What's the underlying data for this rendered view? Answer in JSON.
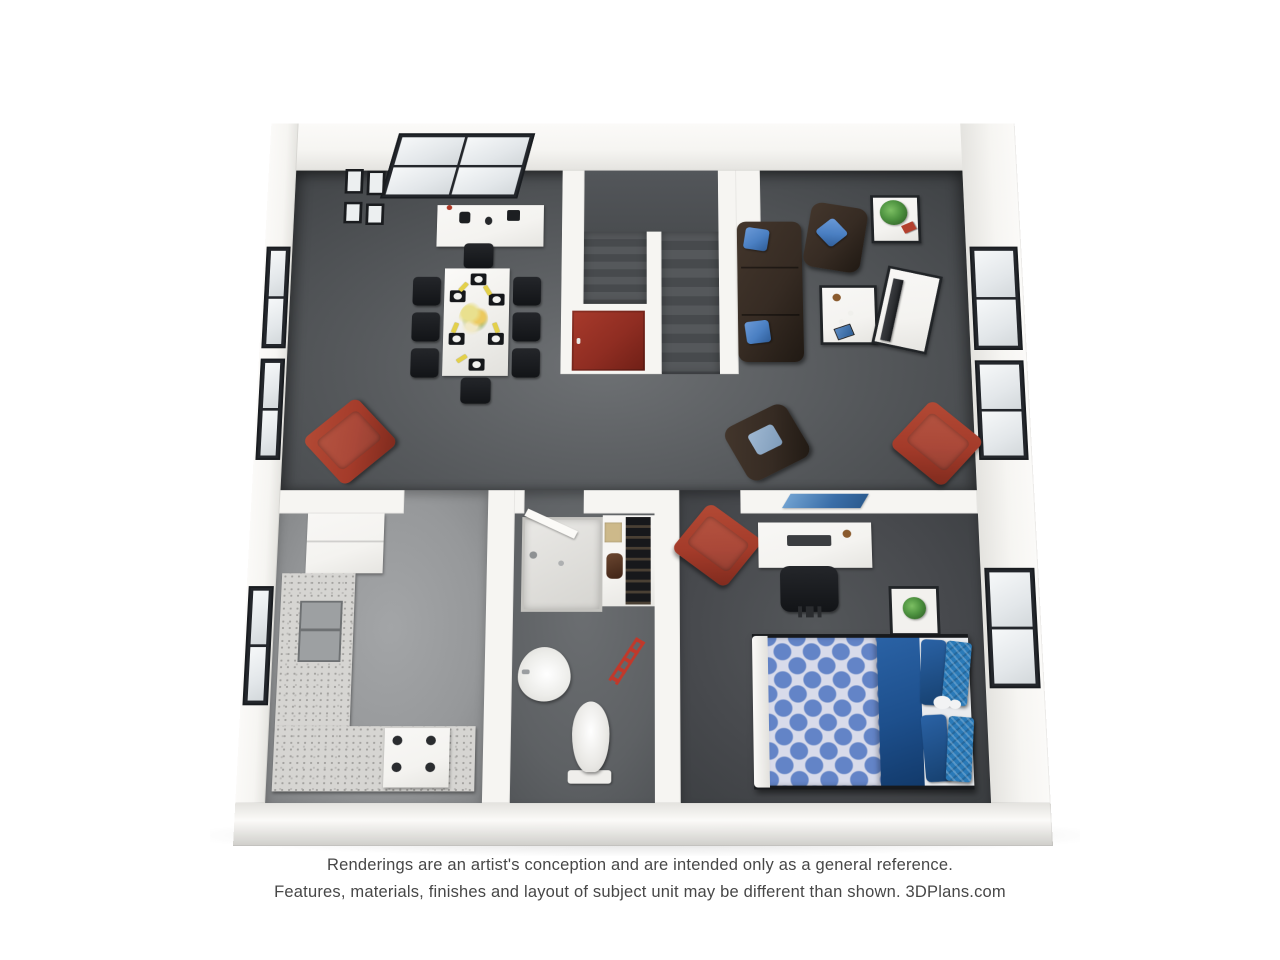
{
  "floorplan": {
    "description": "3D rendered floor plan of a one-bedroom apartment unit",
    "rooms": [
      "dining area",
      "living area",
      "staircase",
      "kitchen",
      "bathroom",
      "closet",
      "bedroom"
    ],
    "colors": {
      "page-bg": "#ffffff",
      "wall": "#f6f5f2",
      "wall-shade": "#e4e3df",
      "wall-edge": "#cfceca",
      "floor-light": "#6e7174",
      "floor-mid": "#56595c",
      "floor-dark": "#3e4144",
      "floor-kitchen": "#96989a",
      "floor-bath": "#5e6164",
      "floor-bed": "#47494d",
      "stair-a": "#55585b",
      "stair-b": "#474a4d",
      "door-red": "#8f2d22",
      "accent-red": "#a43b2a",
      "sofa-brown": "#362b23",
      "pillow-blue": "#4a7fc2",
      "bed-blue": "#6384c7",
      "bed-lattice": "#d8dbea",
      "bed-navy": "#1d4f8c",
      "bed-teal": "#2a7ab8",
      "plant-green": "#4e9340",
      "granite": "#d6d5d2",
      "granite-dot": "#a3a29f",
      "black-furniture": "#212427",
      "white-furniture": "#f4f3f0",
      "tv-dark": "#2b2d30",
      "napkin-yellow": "#e3d04a",
      "text-gray": "#474747"
    }
  },
  "disclaimer": {
    "line1": "Renderings are an artist's conception and are intended only as a general reference.",
    "line2": "Features, materials, finishes and layout of subject unit may be different than shown. 3DPlans.com"
  }
}
